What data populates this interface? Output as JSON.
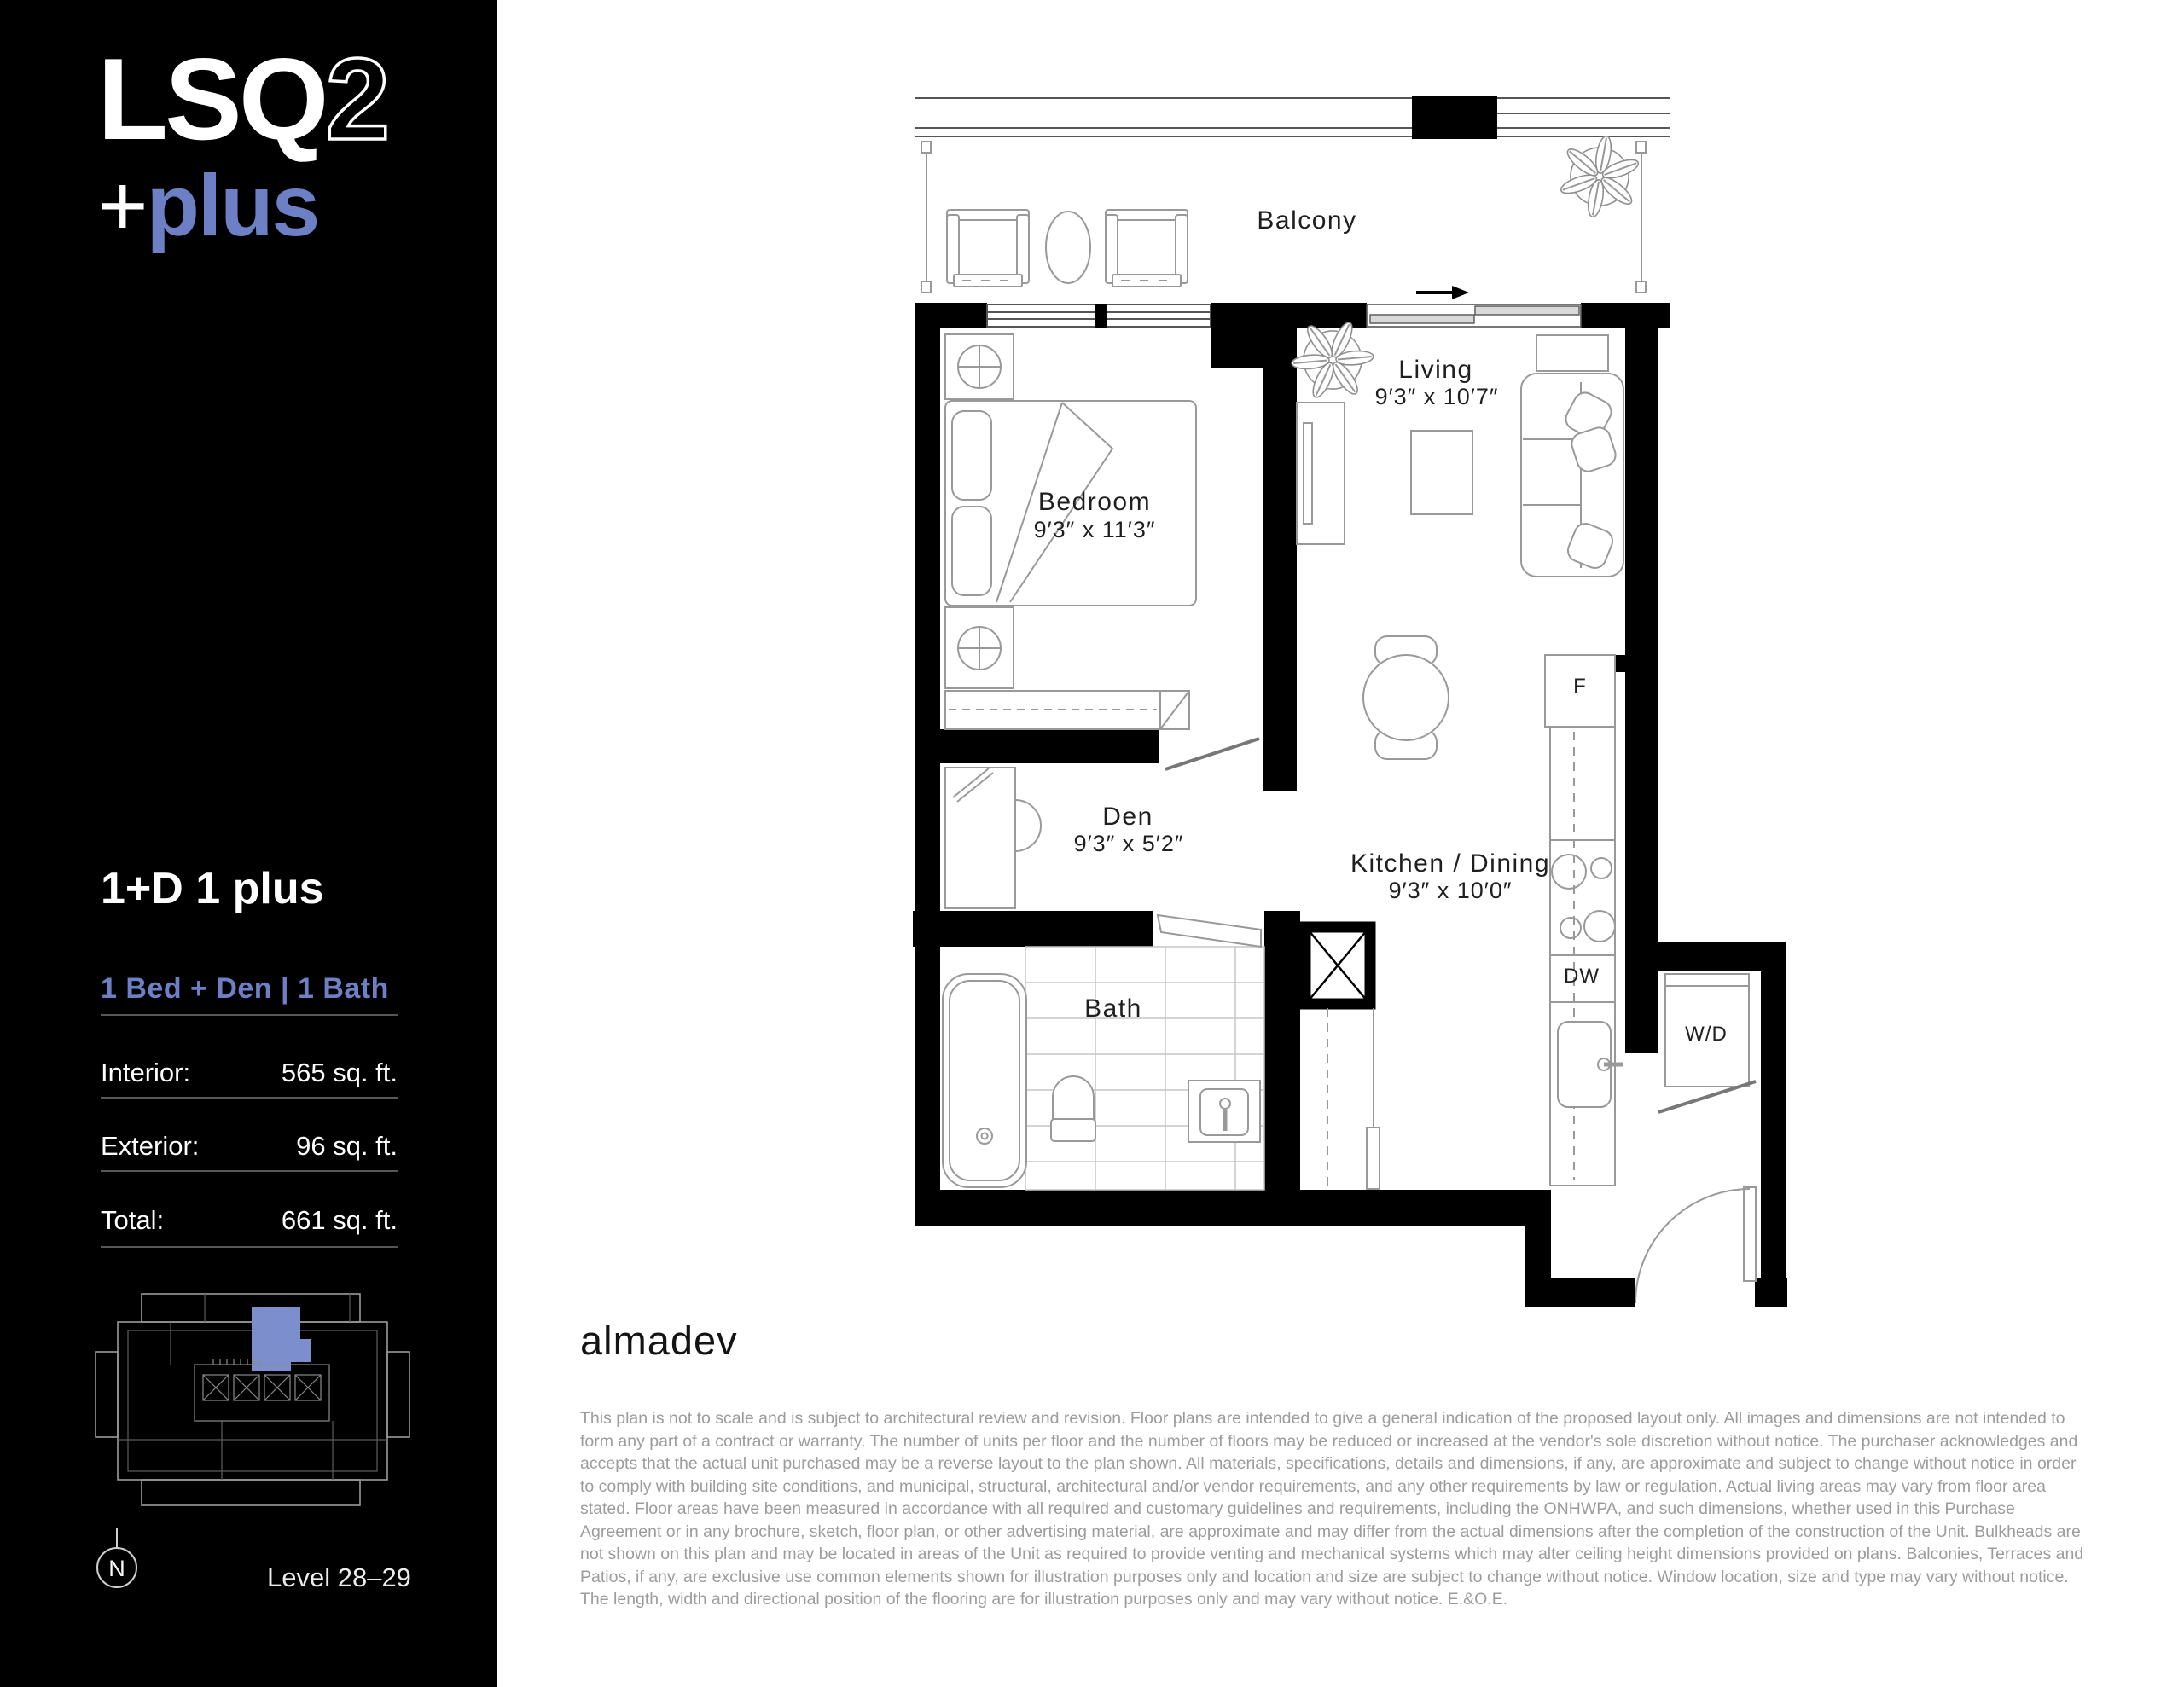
{
  "sidebar": {
    "background": "#000000",
    "accent_color": "#6d80c5",
    "logo": {
      "brand_solid": "LSQ",
      "brand_outline": "2",
      "tagline_plus": "+",
      "tagline_word": "plus"
    },
    "plan_name": "1+D 1 plus",
    "configuration": "1 Bed + Den | 1 Bath",
    "stats": [
      {
        "label": "Interior:",
        "value": "565 sq. ft."
      },
      {
        "label": "Exterior:",
        "value": "96 sq. ft."
      },
      {
        "label": "Total:",
        "value": "661 sq. ft."
      }
    ],
    "keyplan": {
      "compass_label": "N",
      "level_label": "Level 28–29",
      "unit_fill": "#7d8ecd"
    }
  },
  "floorplan": {
    "labels": {
      "balcony": "Balcony",
      "living": "Living",
      "living_dims": "9′3″ x 10′7″",
      "bedroom": "Bedroom",
      "bedroom_dims": "9′3″ x 11′3″",
      "den": "Den",
      "den_dims": "9′3″ x 5′2″",
      "kitchen_dining": "Kitchen / Dining",
      "kitchen_dining_dims": "9′3″ x 10′0″",
      "bath": "Bath",
      "fridge": "F",
      "dishwasher": "DW",
      "washer_dryer": "W/D"
    }
  },
  "footer": {
    "developer": "almadev",
    "disclaimer": "This plan is not to scale and is subject to architectural review and revision. Floor plans are intended to give a general indication of the proposed layout only. All images and dimensions are not intended to form any part of a contract or warranty. The number of units per floor and the number of floors may be reduced or increased at the vendor's sole discretion without notice. The purchaser acknowledges and accepts that the actual unit purchased may be a reverse layout to the plan shown. All materials, specifications, details and dimensions, if any, are approximate and subject to change without notice in order to comply with building site conditions, and municipal, structural, architectural and/or vendor requirements, and any other requirements by law or regulation. Actual living areas may vary from floor area stated. Floor areas have been measured in accordance with all required and customary guidelines and requirements, including the ONHWPA, and such dimensions, whether used in this Purchase Agreement or in any brochure, sketch, floor plan, or other advertising material, are approximate and may differ from the actual dimensions after the completion of the construction of the Unit. Bulkheads are not shown on this plan and may be located in areas of the Unit as required to provide venting and mechanical systems which may alter ceiling height dimensions provided on plans. Balconies, Terraces and Patios, if any, are exclusive use common elements shown for illustration purposes only and location and size are subject to change without notice. Window location, size and type may vary without notice. The length, width and directional position of the flooring are for illustration purposes only and may vary without notice. E.&O.E."
  }
}
